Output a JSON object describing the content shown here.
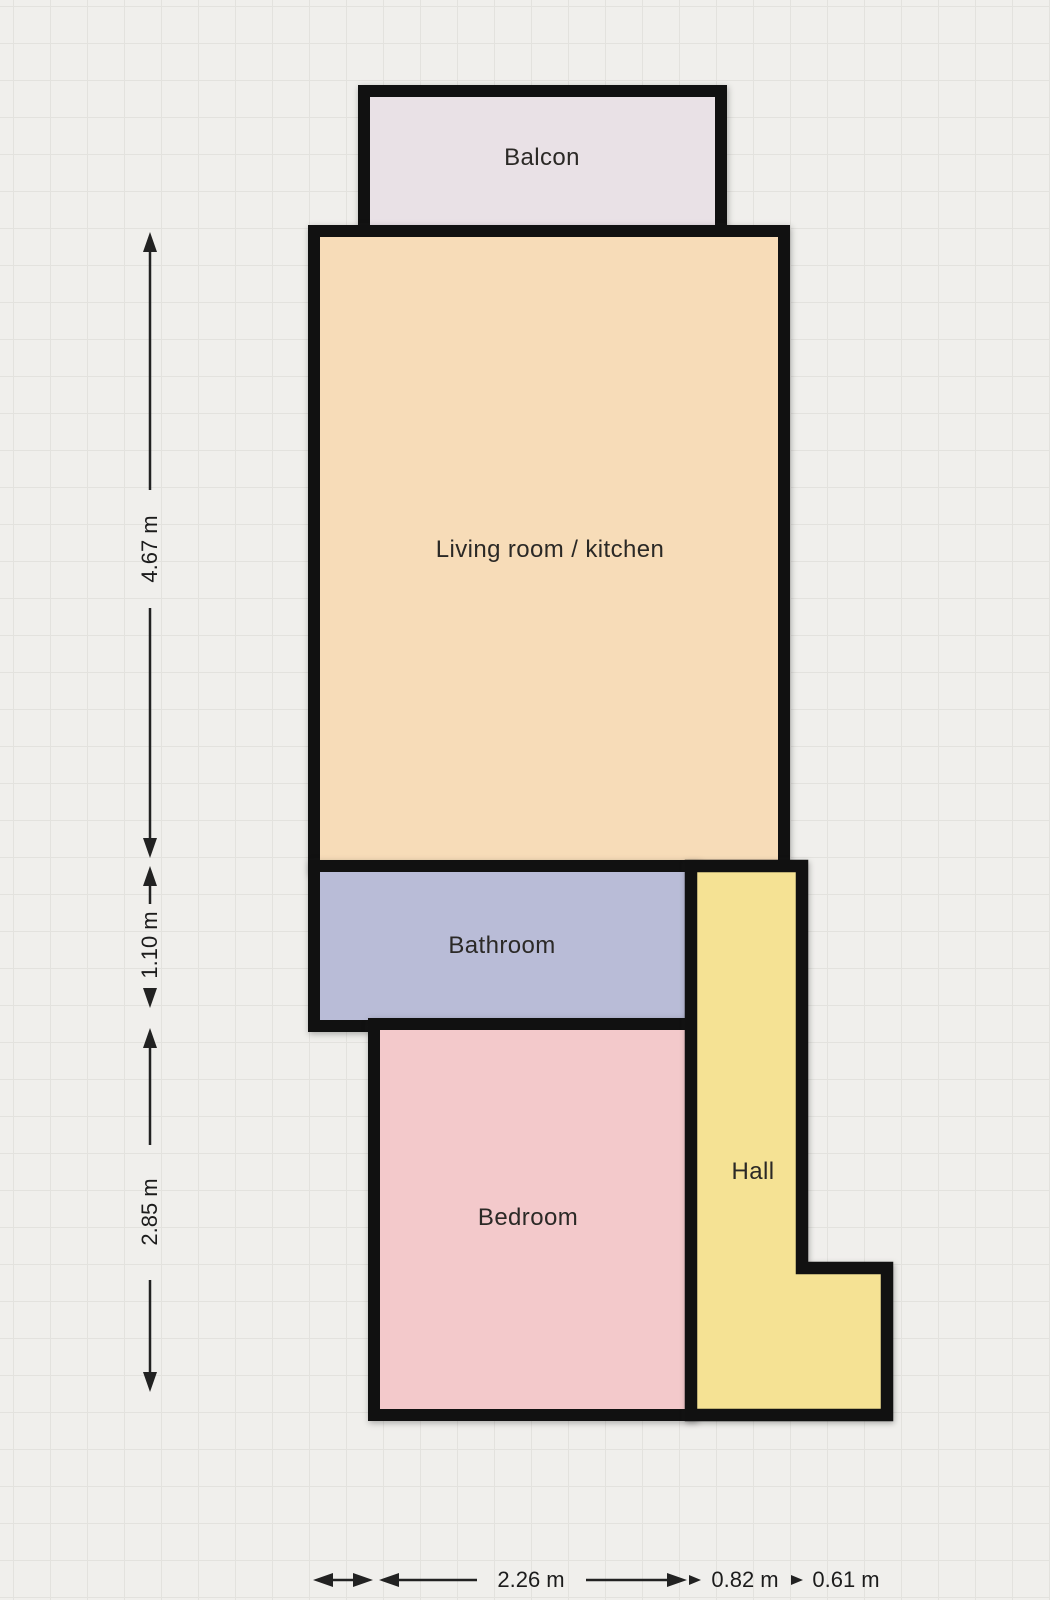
{
  "plan": {
    "rooms": [
      {
        "id": "balcony",
        "label": "Balcon",
        "fill": "#e9e1e6"
      },
      {
        "id": "living-room-kitchen",
        "label": "Living room / kitchen",
        "fill": "#f7dcb8"
      },
      {
        "id": "bathroom",
        "label": "Bathroom",
        "fill": "#b9bcd7"
      },
      {
        "id": "bedroom",
        "label": "Bedroom",
        "fill": "#f3c9cb"
      },
      {
        "id": "hall",
        "label": "Hall",
        "fill": "#f5e294"
      }
    ],
    "dimensions": {
      "vertical": [
        {
          "label": "4.67 m"
        },
        {
          "label": "1.10 m"
        },
        {
          "label": "2.85 m"
        }
      ],
      "horizontal": [
        {
          "label": "2.26 m"
        },
        {
          "label": "0.82 m"
        },
        {
          "label": "0.61 m"
        }
      ]
    },
    "colors": {
      "wall": "#111111",
      "background": "#f0efec",
      "grid_line": "#e3e2de",
      "dimension_line": "#222222"
    }
  }
}
